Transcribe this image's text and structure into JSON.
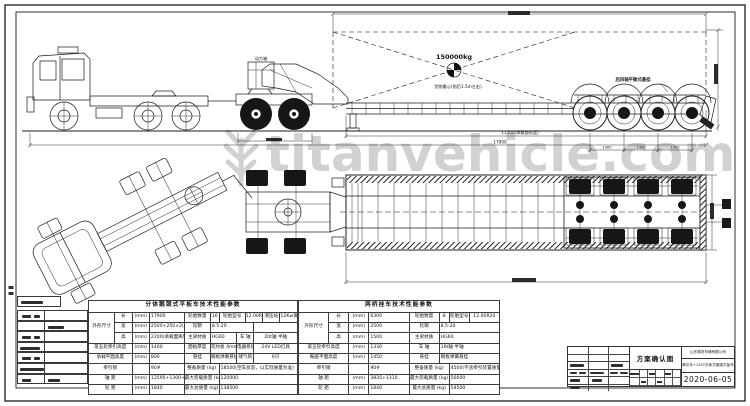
{
  "watermark": {
    "text": "titanvehicle.com"
  },
  "annotations": {
    "power_box": "动力箱",
    "load": "150000kg",
    "cg_note": "货物重心(前后1.5m左右)",
    "rear_note": "后四轴平衡式悬挂",
    "deck_dim": "11500(承载面长度)",
    "overall_dim": "17900",
    "axle_spacing": "1300"
  },
  "titleblock": {
    "drawing_name": "方案确认图",
    "company": "山东泰坦车辆有限公司",
    "project": "牵引车+120T分体式鹅颈平板车",
    "date": "2020-06-05"
  },
  "tables": {
    "left": {
      "units": 24,
      "rows": [
        [
          {
            "t": "分体鹅颈式平板车技术性能参数",
            "c": 24,
            "cls": "tt"
          }
        ],
        [
          {
            "t": "外形尺寸",
            "c": 3,
            "r": 3
          },
          {
            "t": "长",
            "c": 2
          },
          {
            "t": "(mm)",
            "c": 2
          },
          {
            "t": "17900",
            "c": 4,
            "cls": "v"
          },
          {
            "t": "轮胎数量",
            "c": 3
          },
          {
            "t": "16",
            "c": 1
          },
          {
            "t": "轮胎型号",
            "c": 3
          },
          {
            "t": "12.00R20",
            "c": 2
          },
          {
            "t": "液压站",
            "c": 2
          },
          {
            "t": "12Kw发电机组",
            "c": 2
          }
        ],
        [
          {
            "t": "宽",
            "c": 2
          },
          {
            "t": "(mm)",
            "c": 2
          },
          {
            "t": "2500+250×2(外扩宽)",
            "c": 4,
            "cls": "v"
          },
          {
            "t": "轮辋",
            "c": 3
          },
          {
            "t": "8.5-20",
            "c": 5,
            "cls": "v"
          },
          {
            "t": "",
            "c": 5
          }
        ],
        [
          {
            "t": "高",
            "c": 2
          },
          {
            "t": "(mm)",
            "c": 2
          },
          {
            "t": "2200(承载面离地600mm)",
            "c": 4,
            "cls": "v"
          },
          {
            "t": "主梁材质",
            "c": 3
          },
          {
            "t": "HG60",
            "c": 3,
            "cls": "v"
          },
          {
            "t": "车 轴",
            "c": 2
          },
          {
            "t": "20t轴  半轴",
            "c": 5
          }
        ],
        [
          {
            "t": "第五轮牵引高度",
            "c": 5
          },
          {
            "t": "(mm)",
            "c": 2
          },
          {
            "t": "1400",
            "c": 4,
            "cls": "v"
          },
          {
            "t": "面板厚度",
            "c": 3
          },
          {
            "t": "花纹板 4mm",
            "c": 3
          },
          {
            "t": "电器系统",
            "c": 2
          },
          {
            "t": "24V  LED灯具",
            "c": 5
          }
        ],
        [
          {
            "t": "承载平面高度",
            "c": 5
          },
          {
            "t": "(mm)",
            "c": 2
          },
          {
            "t": "800",
            "c": 4,
            "cls": "v"
          },
          {
            "t": "悬挂",
            "c": 3
          },
          {
            "t": "钢板弹簧悬挂",
            "c": 3
          },
          {
            "t": "储气筒",
            "c": 2
          },
          {
            "t": "6只",
            "c": 5
          }
        ],
        [
          {
            "t": "牵引销",
            "c": 5
          },
          {
            "t": "",
            "c": 2
          },
          {
            "t": "90#",
            "c": 4,
            "cls": "v"
          },
          {
            "t": "整备质量 (kg)",
            "c": 4
          },
          {
            "t": "18500(空车状态，以实际质量为准)",
            "c": 9,
            "cls": "v"
          }
        ],
        [
          {
            "t": "轴 距",
            "c": 5
          },
          {
            "t": "(mm)",
            "c": 2
          },
          {
            "t": "12595+1300+1300+1300",
            "c": 4,
            "cls": "v"
          },
          {
            "t": "最大装载质量 (kg)",
            "c": 4
          },
          {
            "t": "120000",
            "c": 9,
            "cls": "v"
          }
        ],
        [
          {
            "t": "轮 距",
            "c": 5
          },
          {
            "t": "(mm)",
            "c": 2
          },
          {
            "t": "1840",
            "c": 4,
            "cls": "v"
          },
          {
            "t": "最大总质量 (kg)",
            "c": 4
          },
          {
            "t": "138500",
            "c": 9,
            "cls": "v"
          }
        ]
      ]
    },
    "right": {
      "units": 20,
      "rows": [
        [
          {
            "t": "两桥挂车技术性能参数",
            "c": 20,
            "cls": "tt"
          }
        ],
        [
          {
            "t": "外形尺寸",
            "c": 3,
            "r": 3
          },
          {
            "t": "长",
            "c": 2
          },
          {
            "t": "(mm)",
            "c": 2
          },
          {
            "t": "6300",
            "c": 4,
            "cls": "v"
          },
          {
            "t": "轮胎数量",
            "c": 3
          },
          {
            "t": "8",
            "c": 1
          },
          {
            "t": "轮胎型号",
            "c": 2
          },
          {
            "t": "12.00R20",
            "c": 3
          }
        ],
        [
          {
            "t": "宽",
            "c": 2
          },
          {
            "t": "(mm)",
            "c": 2
          },
          {
            "t": "2500",
            "c": 4,
            "cls": "v"
          },
          {
            "t": "轮辋",
            "c": 3
          },
          {
            "t": "8.5-20",
            "c": 6,
            "cls": "v"
          }
        ],
        [
          {
            "t": "高",
            "c": 2
          },
          {
            "t": "(mm)",
            "c": 2
          },
          {
            "t": "1500",
            "c": 4,
            "cls": "v"
          },
          {
            "t": "主梁材质",
            "c": 3
          },
          {
            "t": "HG60",
            "c": 6,
            "cls": "v"
          }
        ],
        [
          {
            "t": "第五轮牵引高度",
            "c": 5
          },
          {
            "t": "(mm)",
            "c": 2
          },
          {
            "t": "1330",
            "c": 4,
            "cls": "v"
          },
          {
            "t": "车 轴",
            "c": 3
          },
          {
            "t": "16t轴  半轴",
            "c": 6,
            "cls": "v"
          }
        ],
        [
          {
            "t": "鞍座平面高度",
            "c": 5
          },
          {
            "t": "(mm)",
            "c": 2
          },
          {
            "t": "1450",
            "c": 4,
            "cls": "v"
          },
          {
            "t": "悬挂",
            "c": 3
          },
          {
            "t": "钢板弹簧悬挂",
            "c": 6,
            "cls": "v"
          }
        ],
        [
          {
            "t": "牵引销",
            "c": 5
          },
          {
            "t": "",
            "c": 2
          },
          {
            "t": "90#",
            "c": 4,
            "cls": "v"
          },
          {
            "t": "整备质量 (kg)",
            "c": 4
          },
          {
            "t": "4500(不含牵引装置质量)",
            "c": 5,
            "cls": "v"
          }
        ],
        [
          {
            "t": "轴 距",
            "c": 5
          },
          {
            "t": "(mm)",
            "c": 2
          },
          {
            "t": "3835+1310",
            "c": 4,
            "cls": "v"
          },
          {
            "t": "最大装载质量 (kg)",
            "c": 4
          },
          {
            "t": "50000",
            "c": 5,
            "cls": "v"
          }
        ],
        [
          {
            "t": "轮 距",
            "c": 5
          },
          {
            "t": "(mm)",
            "c": 2
          },
          {
            "t": "1840",
            "c": 4,
            "cls": "v"
          },
          {
            "t": "最大总质量 (kg)",
            "c": 4
          },
          {
            "t": "54500",
            "c": 5,
            "cls": "v"
          }
        ]
      ]
    }
  }
}
